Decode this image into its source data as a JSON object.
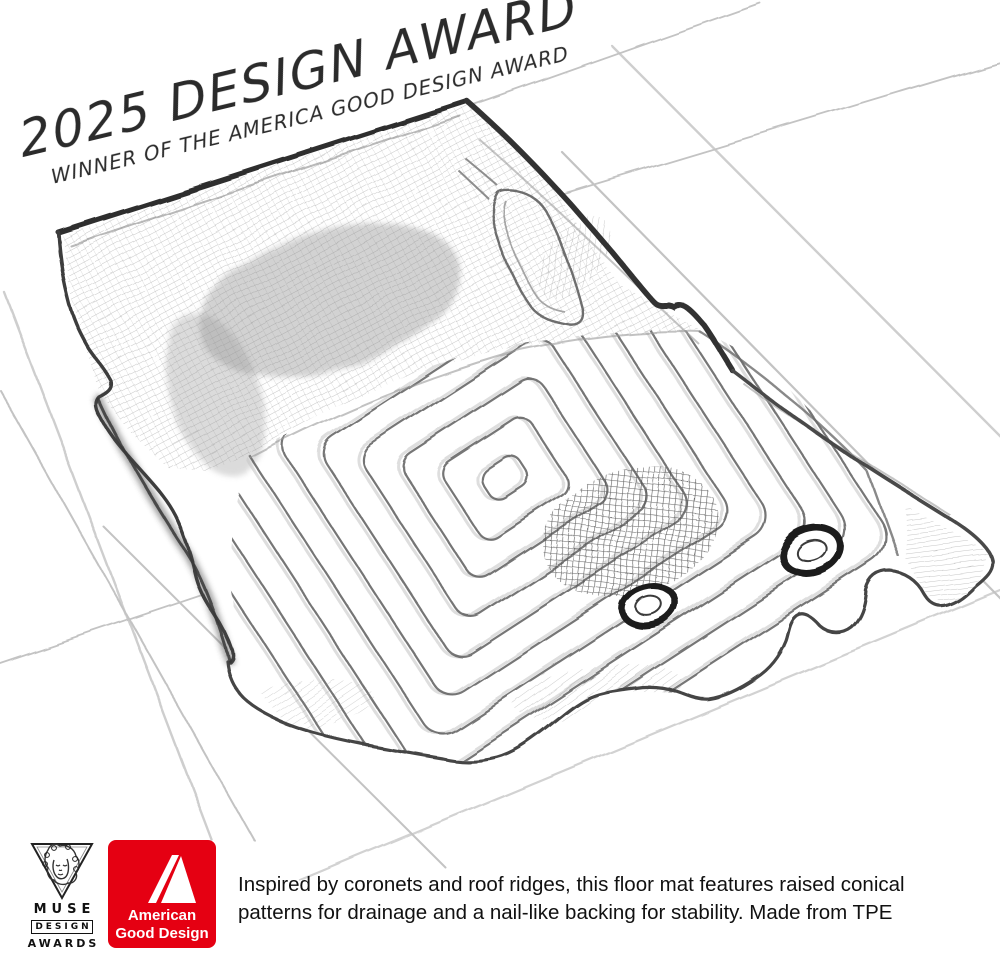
{
  "banner": {
    "title": "2025 DESIGN AWARD",
    "subtitle": "WINNER OF THE AMERICA GOOD DESIGN AWARD"
  },
  "caption": {
    "line1": "Inspired by coronets and roof ridges, this floor mat features raised conical",
    "line2": "patterns for drainage and a nail-like backing for stability. Made from TPE"
  },
  "logos": {
    "muse": {
      "name": "MUSE Design Awards",
      "icon": "muse-face-triangle-icon",
      "word1": "MUSE",
      "word2": "DESIGN",
      "word3": "AWARDS"
    },
    "agd": {
      "name": "American Good Design",
      "icon": "stylized-a-icon",
      "word1": "American",
      "word2": "Good Design",
      "background": "#e50012",
      "foreground": "#ffffff"
    }
  },
  "illustration": {
    "subject": "pencil sketch of a car floor mat with chevron ridge pattern and two grommet holes",
    "pencil_color": "#3a3a3a",
    "grid_color": "#a2a2a2",
    "background": "#ffffff"
  }
}
